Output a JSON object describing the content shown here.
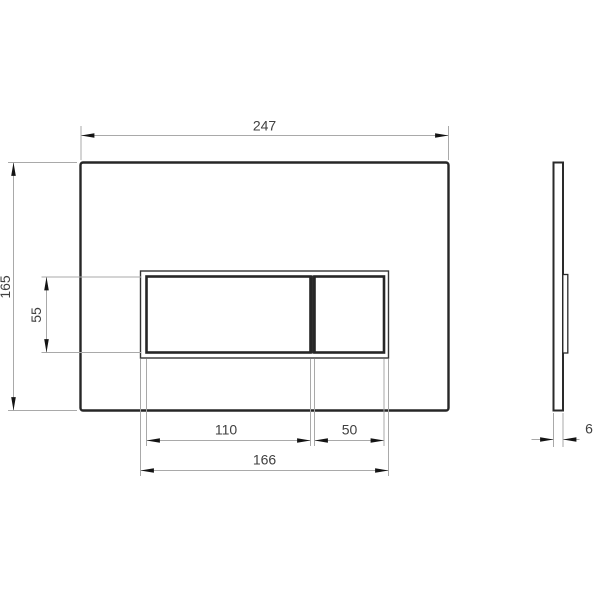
{
  "drawing": {
    "kind": "technical-dimension-drawing",
    "views": {
      "front_view": "flush-plate front elevation with two rectangular buttons",
      "side_view": "flush-plate side profile with button protrusion"
    },
    "labels": {
      "plate_width": "247",
      "plate_height": "165",
      "button_height": "55",
      "large_button_width": "110",
      "small_button_width": "50",
      "button_frame_width": "166",
      "plate_thickness": "6"
    },
    "colors": {
      "background": "#ffffff",
      "outline": "#262626",
      "dimension_lines": "#a9a9a9",
      "arrowheads": "#141414",
      "dimension_text": "#404040"
    }
  }
}
